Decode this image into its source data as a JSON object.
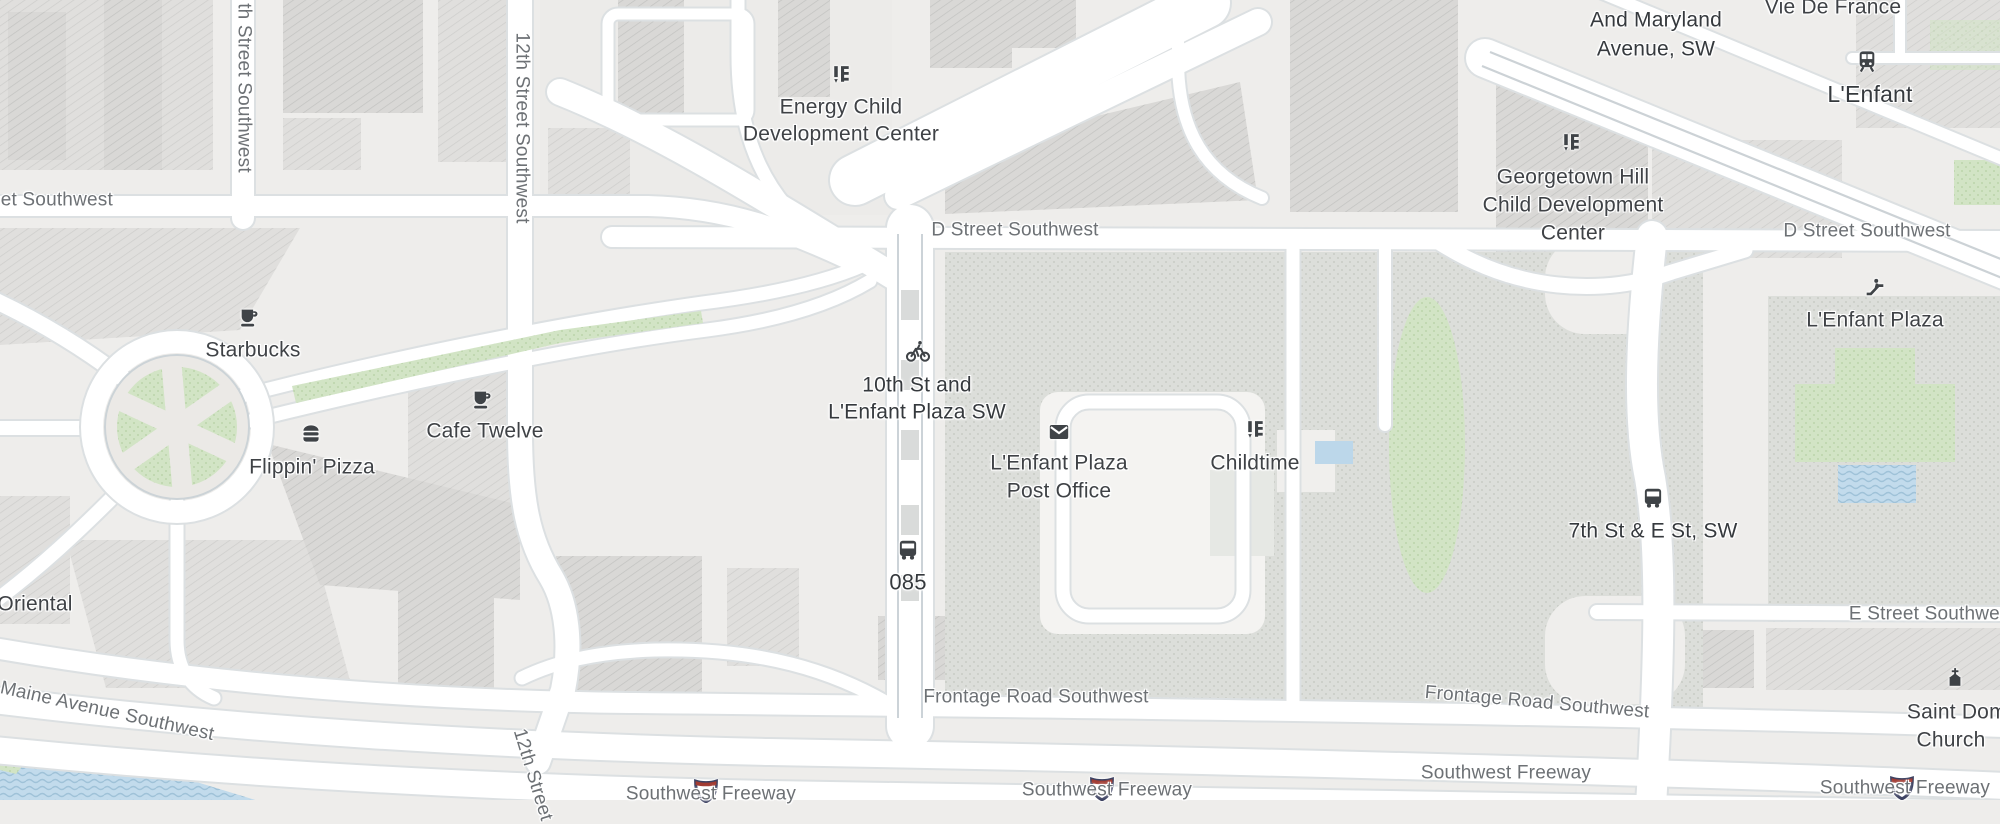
{
  "pois": {
    "starbucks": {
      "label": "Starbucks"
    },
    "cafe_twelve": {
      "label": "Cafe Twelve"
    },
    "flippin_pizza": {
      "label": "Flippin' Pizza"
    },
    "energy_cdc": {
      "line1": "Energy Child",
      "line2": "Development Center"
    },
    "georgetown_cdc": {
      "line1": "Georgetown Hill",
      "line2": "Child Development",
      "line3": "Center"
    },
    "childtime": {
      "label": "Childtime"
    },
    "post_office": {
      "line1": "L'Enfant Plaza",
      "line2": "Post Office"
    },
    "vie_de_france": {
      "label": "Vie De France"
    },
    "saint_dominic": {
      "line1": "Saint Dominic",
      "line2": "Church"
    },
    "oriental": {
      "label": "Oriental"
    },
    "lenfant_plaza_entrance": {
      "label": "L'Enfant Plaza"
    }
  },
  "transit": {
    "lenfant_station": {
      "label": "L'Enfant"
    },
    "bikeshare_10th": {
      "line1": "10th St and",
      "line2": "L'Enfant Plaza SW"
    },
    "bus_085": {
      "label": "085"
    },
    "bus_7th_e": {
      "label": "7th St & E St, SW"
    },
    "stop_7th_maryland": {
      "line1": "7th Street SW",
      "line2": "And Maryland",
      "line3": "Avenue, SW"
    }
  },
  "streets": {
    "s13th": "th Street Southwest",
    "left_partial": "Street Southwest",
    "s12th": "12th Street Southwest",
    "d_street_a": "D Street Southwest",
    "d_street_b": "D Street Southwest",
    "maine_ave": "Maine Avenue Southwest",
    "frontage_a": "Frontage Road Southwest",
    "frontage_b": "Frontage Road Southwest",
    "e_street": "E Street Southwest",
    "freeway_a": "Southwest Freeway",
    "freeway_b": "Southwest Freeway",
    "freeway_c": "Southwest Freeway",
    "freeway_d": "Southwest Freeway",
    "s12th_ramp": "12th Street"
  },
  "colors": {
    "land": "#eeedeb",
    "road": "#ffffff",
    "park_green": "#d2e4c5",
    "water_blue": "#c2dbec",
    "building_gray": "#d9d8d6",
    "poi_text": "#3f4246",
    "street_text": "#6d7175"
  }
}
